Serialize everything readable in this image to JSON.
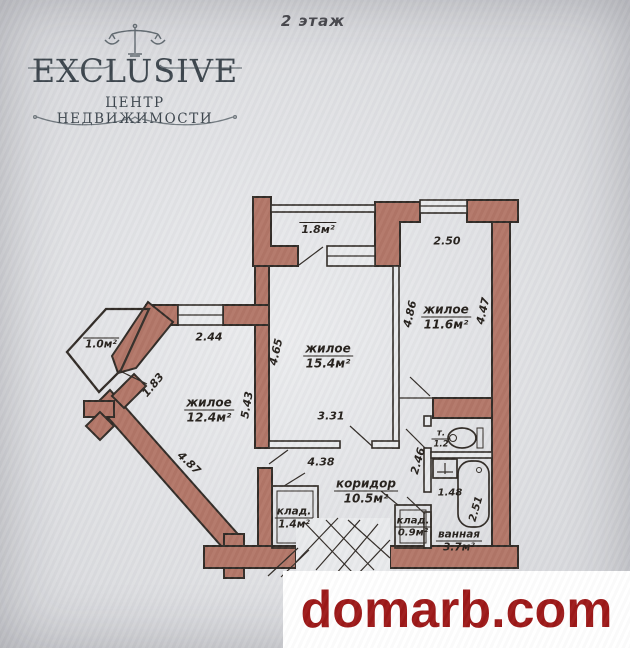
{
  "header": {
    "floor_label": "2 этаж"
  },
  "logo": {
    "brand": "EXCLUSIVE",
    "subtitle": "ЦЕНТР НЕДВИЖИМОСТИ",
    "icon": "scales-of-justice-icon",
    "color": "#39424a"
  },
  "watermark": {
    "site": "domarb.com",
    "color": "#9b1414"
  },
  "floorplan": {
    "wall_color": "#b17465",
    "line_color": "#2e2823",
    "paper_color": "#e9eaec",
    "fixtures": [
      "toilet-icon",
      "sink-icon",
      "bathtub-icon",
      "staircase-icon"
    ],
    "living_large": {
      "name": "жилое",
      "area": "15.4м²"
    },
    "living_right": {
      "name": "жилое",
      "area": "11.6м²"
    },
    "living_left": {
      "name": "жилое",
      "area": "12.4м²"
    },
    "corridor": {
      "name": "коридор",
      "area": "10.5м²"
    },
    "storage_large": {
      "name": "клад.",
      "area": "1.4м²"
    },
    "storage_small": {
      "name": "клад.",
      "area": "0.9м²"
    },
    "bathroom": {
      "name": "ванная",
      "area": "3.7м²"
    },
    "wc": {
      "name": "т.",
      "area": "1.2"
    },
    "balcony_top": {
      "area": "1.8м²"
    },
    "balcony_left": {
      "area": "1.0м²"
    },
    "dims": {
      "top_right_width": "2.50",
      "right_room_left": "4.86",
      "right_room_right": "4.47",
      "left_room_width": "2.44",
      "balcony_door": "1.83",
      "left_room_height": "5.43",
      "large_room_left": "4.65",
      "large_room_bottom": "3.31",
      "corridor_width": "4.38",
      "corridor_right": "2.46",
      "bathroom_width": "1.48",
      "bathroom_height": "2.51",
      "diagonal_wall": "4.87"
    }
  }
}
